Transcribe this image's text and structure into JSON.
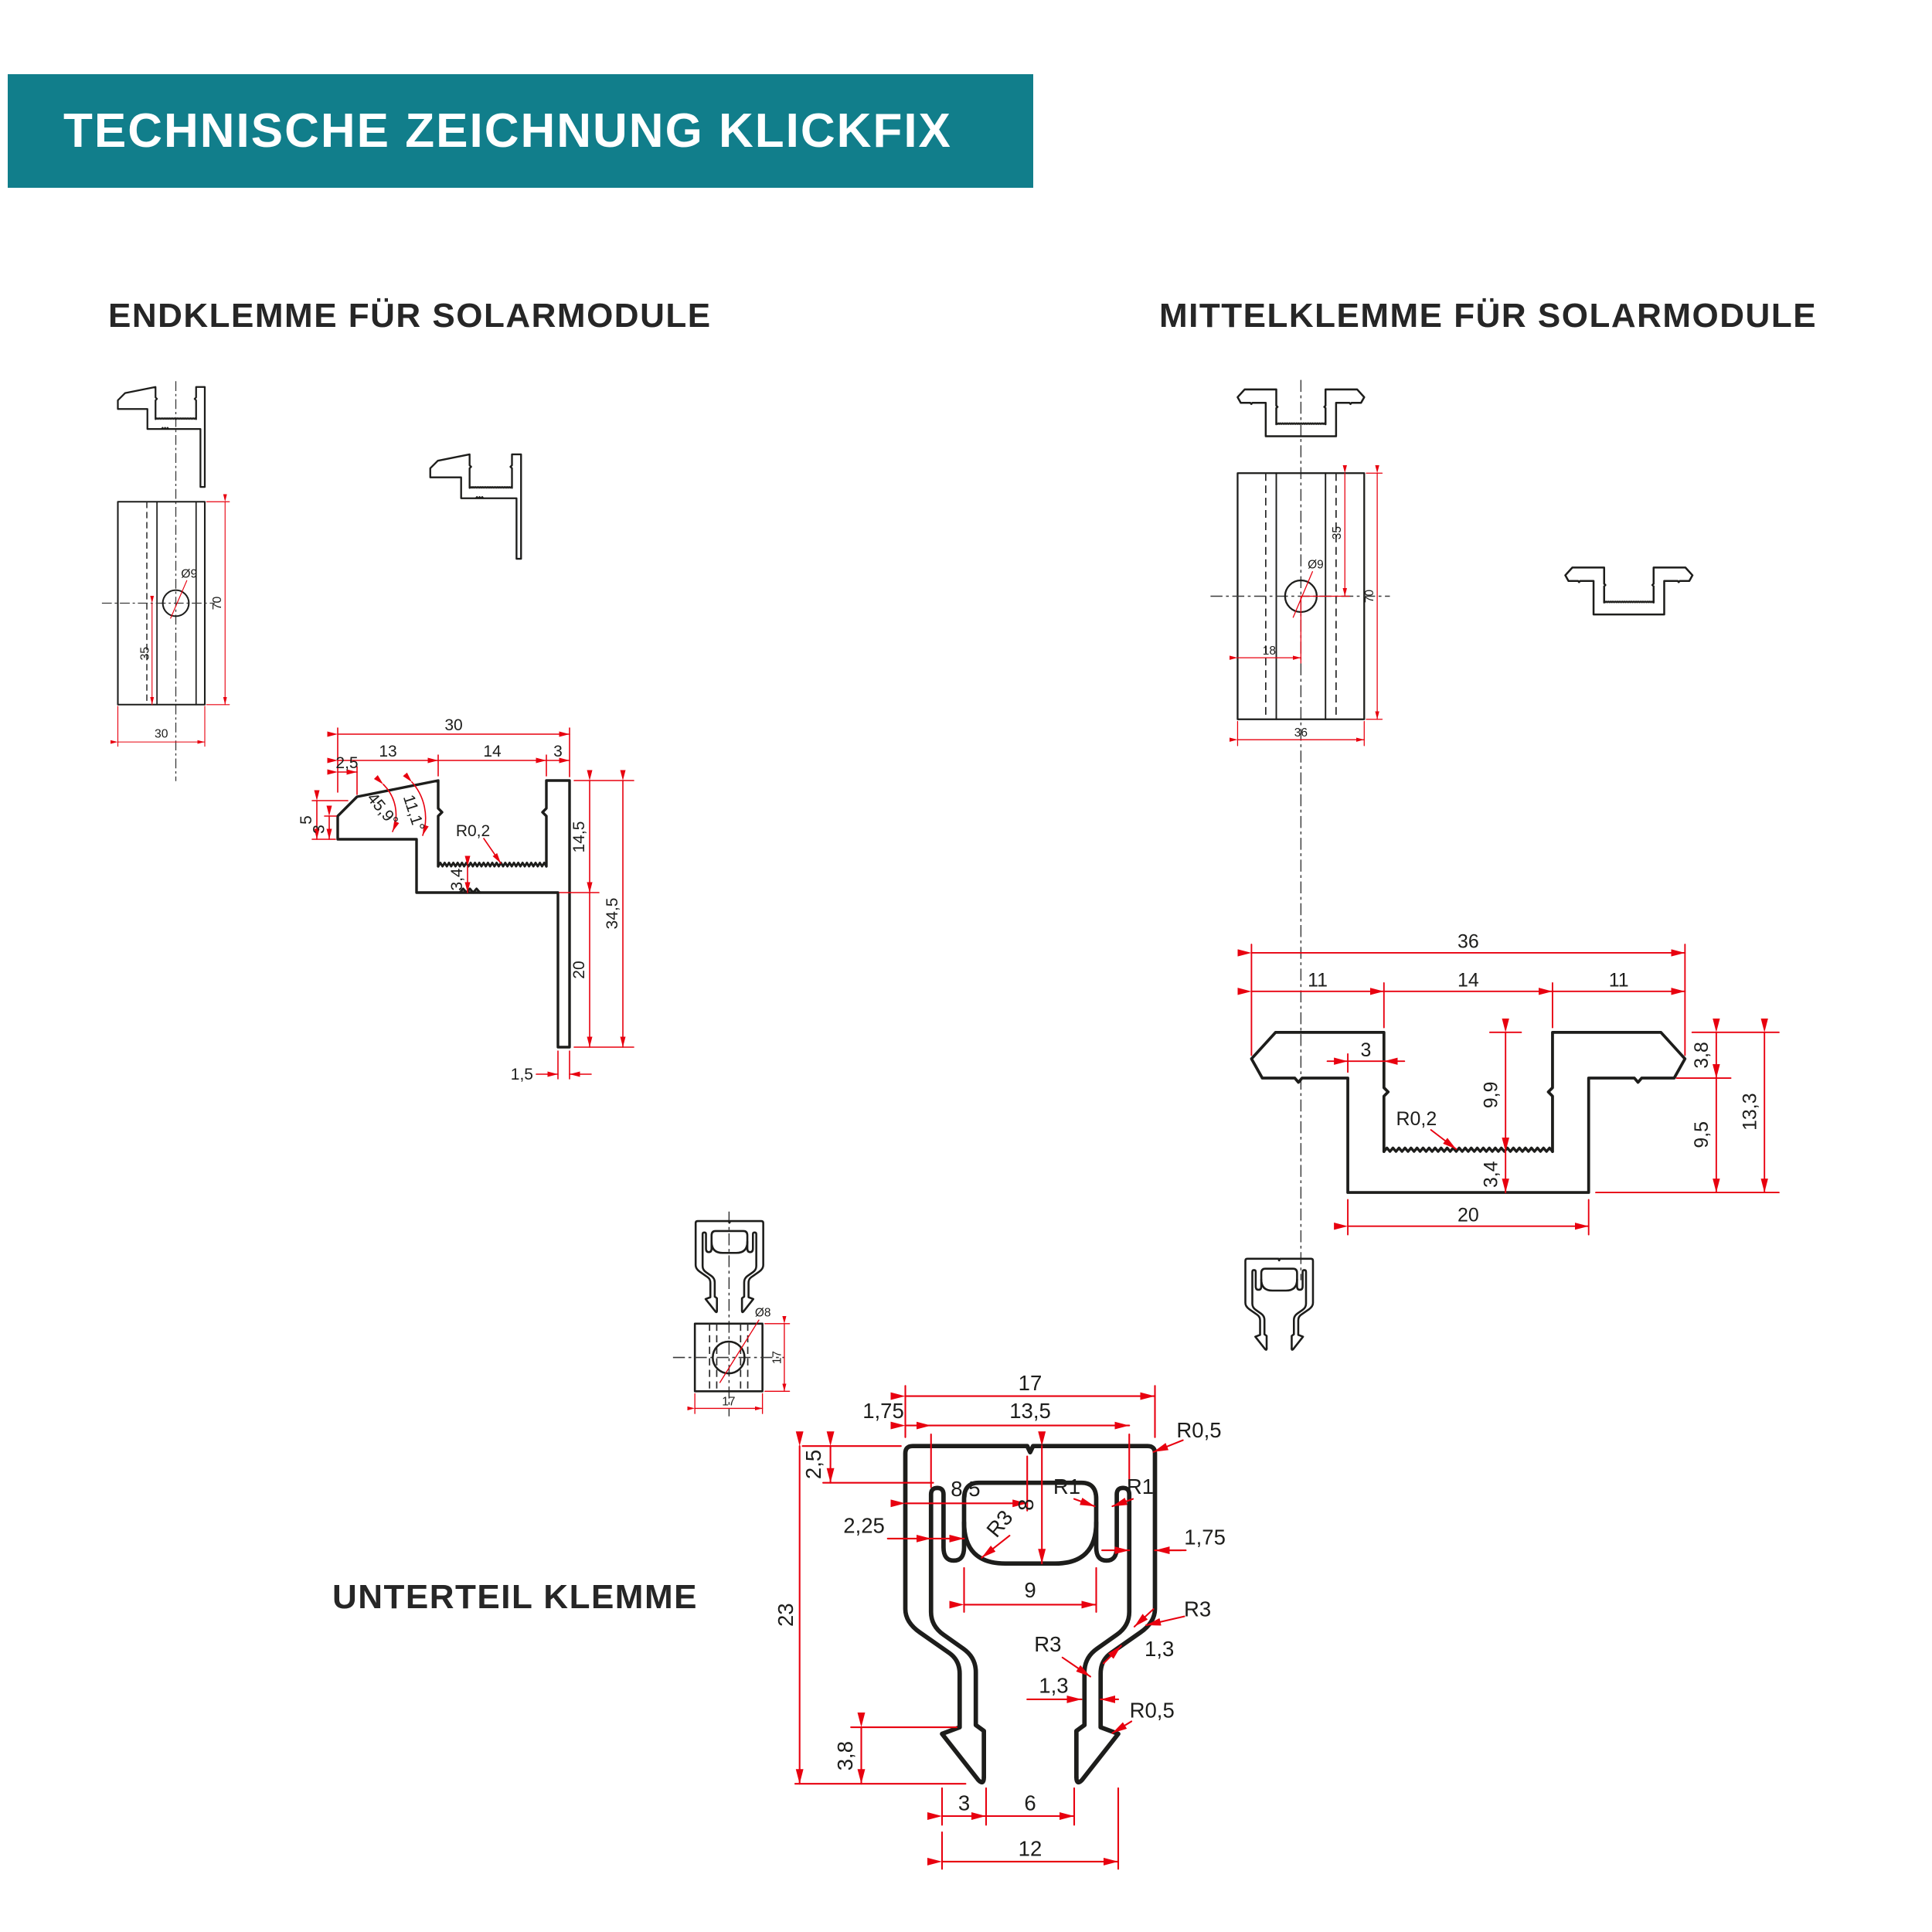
{
  "header": {
    "title": "TECHNISCHE ZEICHNUNG KLICKFIX"
  },
  "colors": {
    "teal": "#117e8b",
    "red": "#e8000f",
    "ink": "#1d1d1b"
  },
  "endklemme": {
    "title": "ENDKLEMME FÜR SOLARMODULE",
    "plan": {
      "hole": "Ø9",
      "height": "70",
      "offset": "35",
      "width": "30"
    },
    "cross": {
      "w": "30",
      "w1": "13",
      "w2": "14",
      "w3": "3",
      "chamfer": "2,5",
      "lip_h": "5",
      "lip_t": "3",
      "ang1": "45,9°",
      "ang2": "11,1°",
      "r": "R0,2",
      "floor": "3,4",
      "d1": "14,5",
      "total": "34,5",
      "leg": "20",
      "leg_t": "1,5"
    }
  },
  "mittelklemme": {
    "title": "MITTELKLEMME FÜR SOLARMODULE",
    "plan": {
      "hole": "Ø9",
      "height": "70",
      "offset": "35",
      "offset_x": "18",
      "width": "36"
    },
    "cross": {
      "w": "36",
      "w1": "11",
      "w2": "14",
      "w3": "11",
      "notch": "3",
      "depth": "9,9",
      "r": "R0,2",
      "floor": "3,4",
      "wing": "3,8",
      "h": "13,3",
      "body": "9,5",
      "base": "20"
    }
  },
  "unterteil": {
    "title": "UNTERTEIL KLEMME",
    "plan": {
      "hole": "Ø8",
      "width": "17",
      "height": "17"
    },
    "cross": {
      "w": "17",
      "edge": "1,75",
      "top_in": "13,5",
      "r_top": "R0,5",
      "web": "2,5",
      "half": "8,5",
      "r1a": "R1",
      "r1b": "R1",
      "slot_d": "8",
      "wall": "2,25",
      "r_slot": "R3",
      "wall_r": "1,75",
      "slot_w": "9",
      "h": "23",
      "r_leg": "R3",
      "leg_t1": "1,3",
      "r_leg2": "R3",
      "leg_t2": "1,3",
      "r_foot": "R0,5",
      "foot_h": "3,8",
      "foot_w": "3",
      "gap": "6",
      "feet_w": "12"
    }
  }
}
